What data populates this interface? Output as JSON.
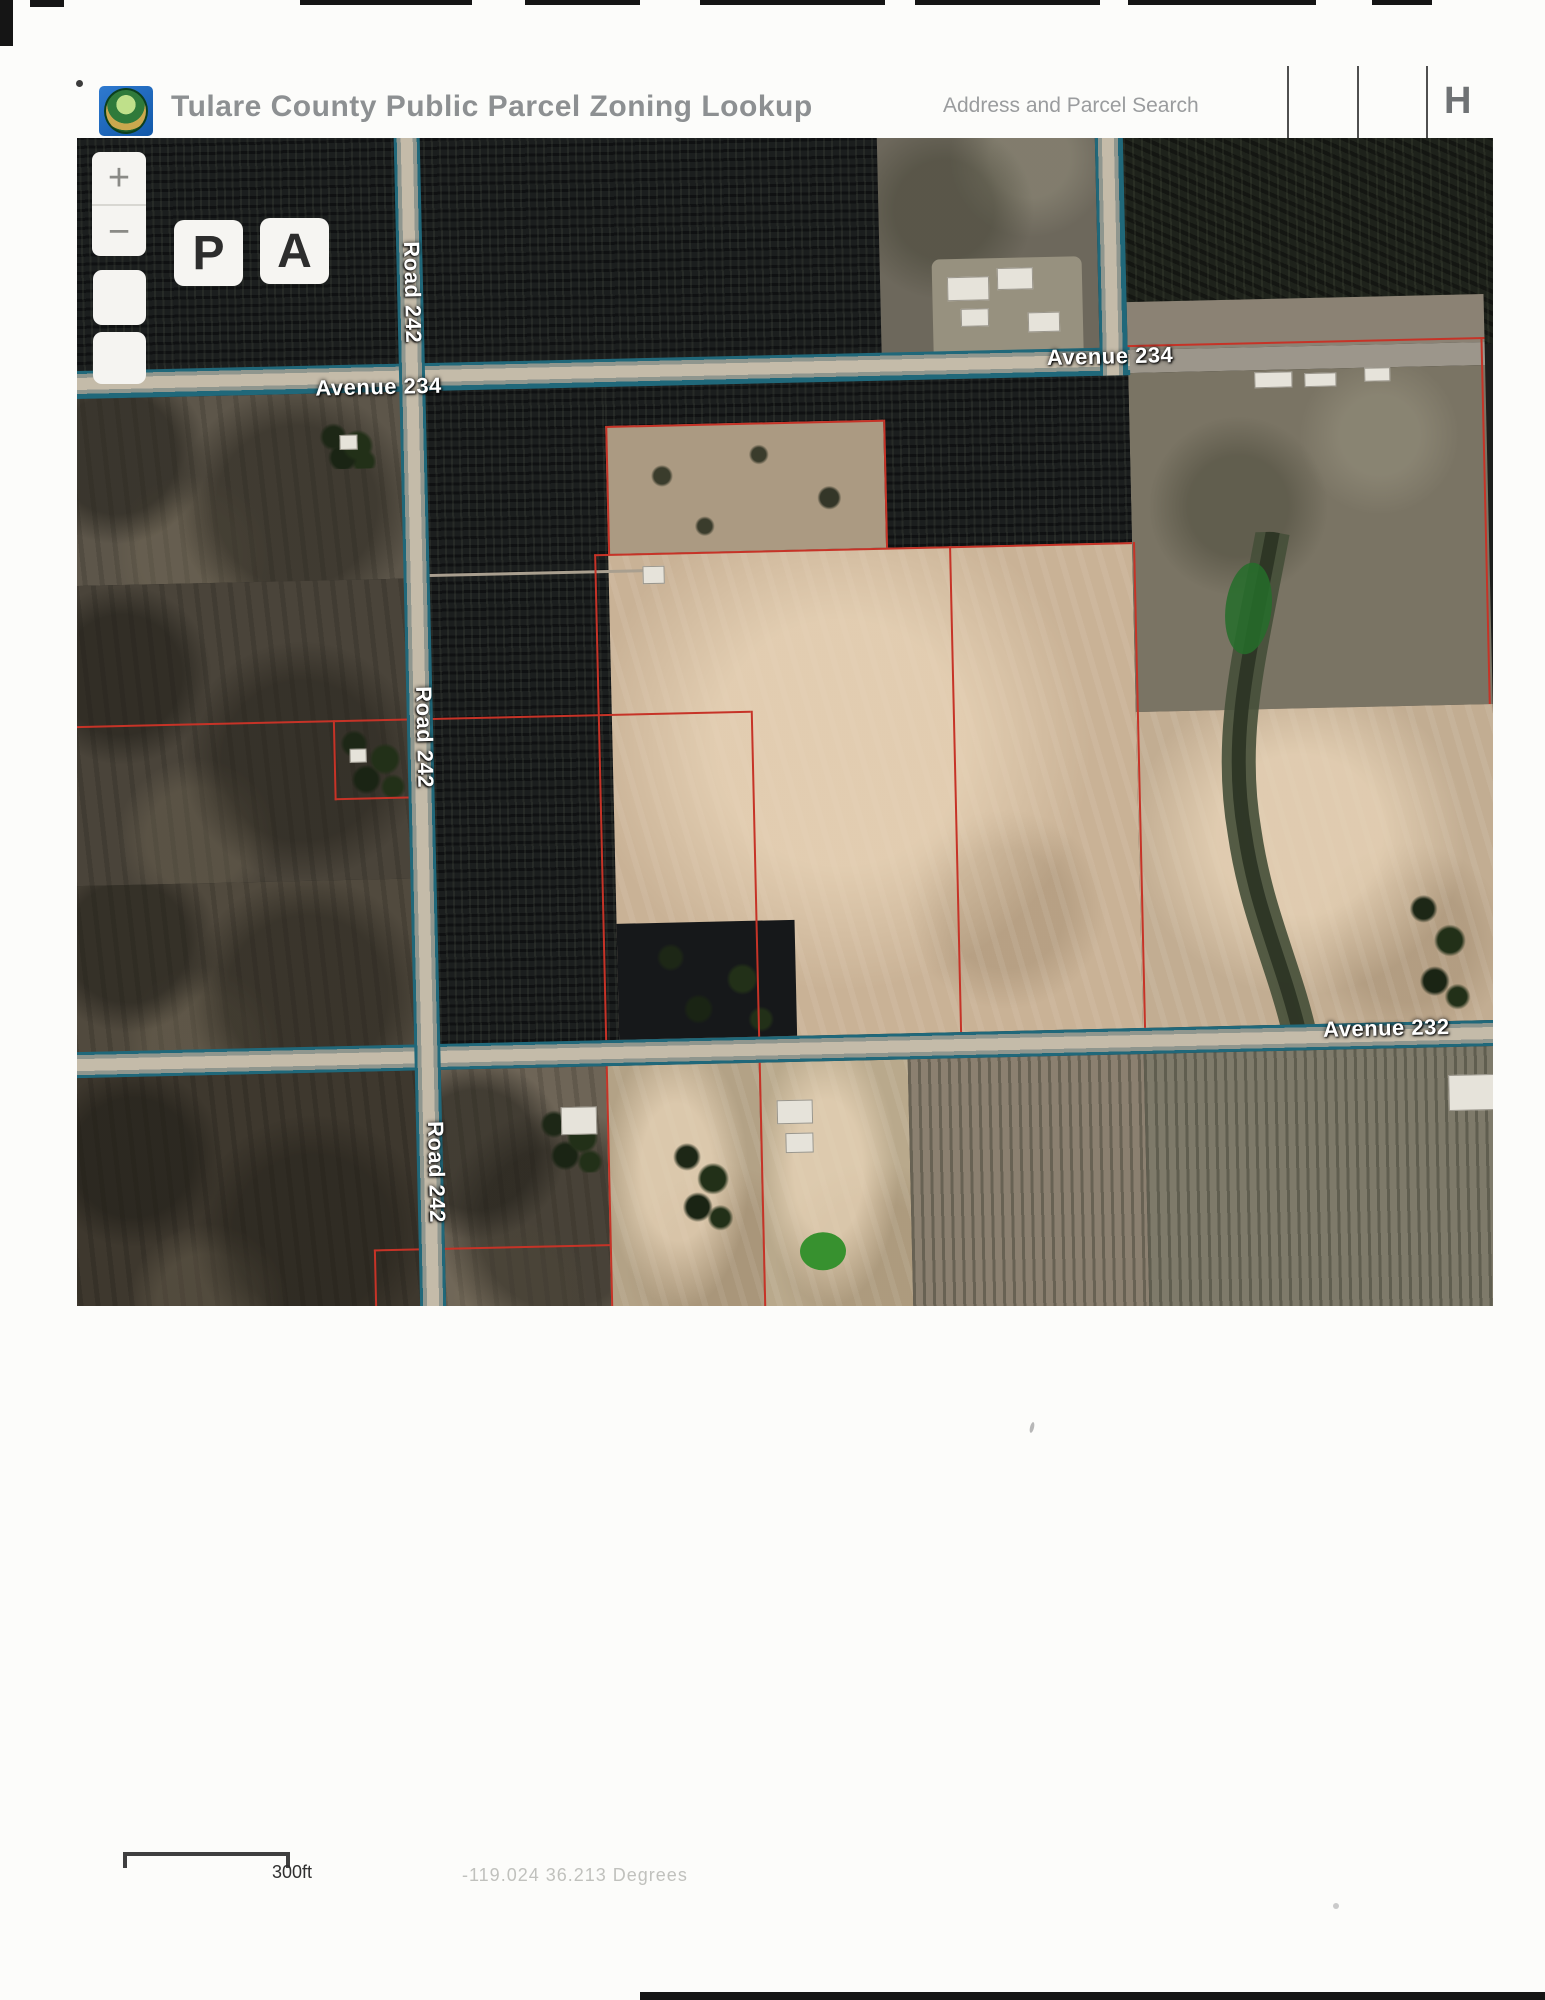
{
  "header": {
    "title": "Tulare County Public Parcel Zoning Lookup",
    "search_label": "Address and Parcel Search",
    "home_button": "H"
  },
  "map": {
    "controls": {
      "zoom_in": "+",
      "zoom_out": "−",
      "parcel_button": "P",
      "address_button": "A"
    },
    "labels": {
      "road_242": "Road 242",
      "avenue_234": "Avenue 234",
      "avenue_232": "Avenue 232"
    },
    "colors": {
      "road_edge_teal": "#20687a",
      "parcel_line_red": "#c63327",
      "road_label_text": "#ffffff"
    }
  },
  "footer": {
    "scale_label": "300ft",
    "coordinates": "-119.024 36.213 Degrees"
  }
}
